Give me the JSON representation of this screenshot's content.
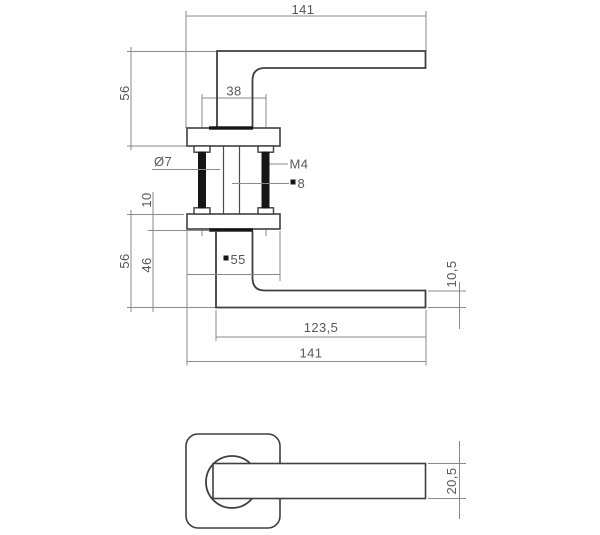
{
  "drawing": {
    "type": "technical-dimension-drawing",
    "subject": "door handle lever on square rosette",
    "colors": {
      "background": "#ffffff",
      "object_line": "#3f3f3f",
      "thin_line": "#8a8a8a",
      "black_fill": "#161616",
      "text": "#575757"
    },
    "views": {
      "top": {
        "total_length": "141",
        "height": "56",
        "screw_spacing": "38"
      },
      "section": {
        "screw_hole_diameter": "Ø7",
        "thread_label": "M4",
        "spindle_square_label": "8",
        "rosette_thickness": "10"
      },
      "side": {
        "height": "56",
        "neck_height": "46",
        "rosette_square_label": "55",
        "grip_length": "123,5",
        "total_length": "141",
        "lever_thickness": "10,5"
      },
      "front": {
        "lever_width": "20,5"
      }
    }
  }
}
